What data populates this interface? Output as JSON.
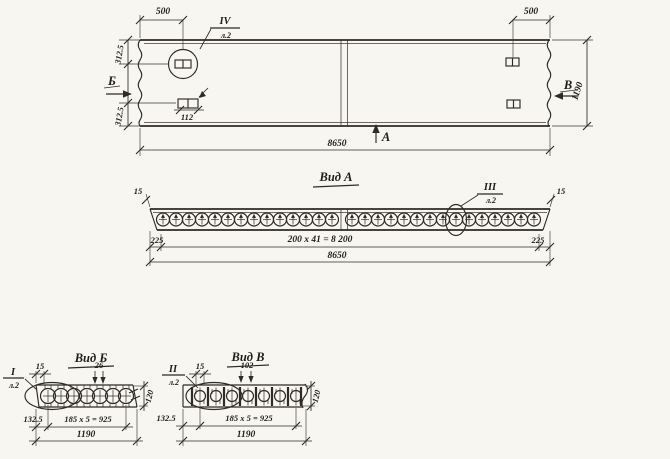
{
  "palette": {
    "paper": "#f7f6f1",
    "ink": "#2e2b26"
  },
  "plan": {
    "dim_500_left": "500",
    "dim_500_right": "500",
    "dim_3125_top": "312.5",
    "dim_3125_bottom": "312.5",
    "dim_112": "112",
    "dim_1190": "1190",
    "dim_8650": "8650",
    "label_a": "А",
    "label_b": "Б",
    "label_v": "В",
    "flag_iv_num": "IV",
    "flag_iv_sheet": "л.2"
  },
  "view_a": {
    "title": "Вид А",
    "dim_15_left": "15",
    "dim_15_right": "15",
    "dim_225_left": "225",
    "dim_225_right": "225",
    "dim_row": "200 x 41 = 8 200",
    "dim_total": "8650",
    "flag_iii_num": "III",
    "flag_iii_sheet": "л.2",
    "holes_left": 14,
    "holes_right": 15
  },
  "view_b": {
    "title": "Вид Б",
    "dim_15": "15",
    "dim_26": "26",
    "dim_1325": "132.5",
    "dim_row": "185 x 5 = 925",
    "dim_total": "1190",
    "dim_thickness": "120",
    "flag_i_num": "I",
    "flag_i_sheet": "л.2",
    "holes": 7
  },
  "view_v": {
    "title": "Вид В",
    "dim_15": "15",
    "dim_102": "102",
    "dim_1325": "132.5",
    "dim_row": "185 x 5 = 925",
    "dim_total": "1190",
    "dim_thickness": "120",
    "flag_ii_num": "II",
    "flag_ii_sheet": "л.2",
    "holes": 7
  }
}
